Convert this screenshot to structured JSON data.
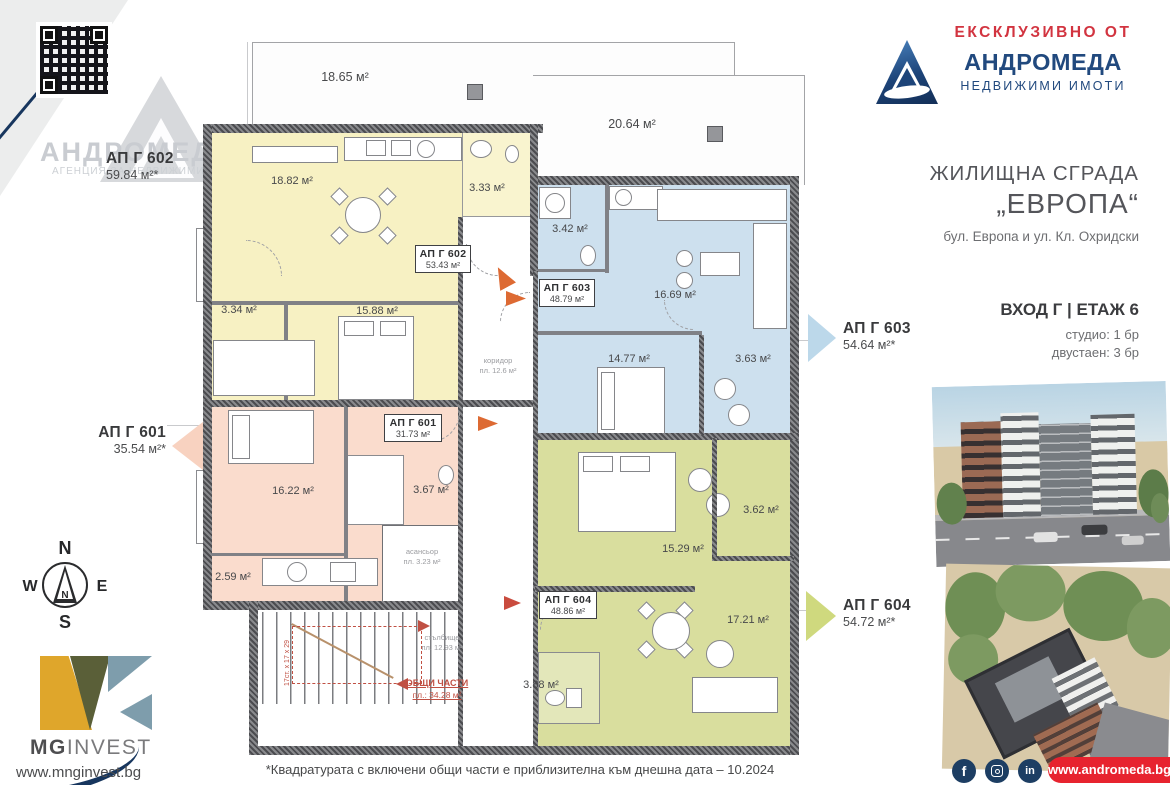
{
  "header": {
    "exclusive": "ЕКСКЛУЗИВНО ОТ",
    "agency": "АНДРОМЕДА",
    "tagline": "НЕДВИЖИМИ ИМОТИ"
  },
  "watermark": {
    "agency": "АНДРОМЕДА",
    "tagline": "АГЕНЦИЯ ЗА НЕДВИЖИМИ ИМОТИ"
  },
  "project": {
    "title1": "ЖИЛИЩНА СГРАДА",
    "title2": "„ЕВРОПА“",
    "address": "бул. Европа и ул. Кл. Охридски",
    "entrance": "ВХОД Г | ЕТАЖ 6",
    "mix1": "студио: 1 бр",
    "mix2": "двустаен: 3 бр"
  },
  "callouts": {
    "g602": {
      "name": "АП Г 602",
      "area": "59.84 м²*"
    },
    "g601": {
      "name": "АП Г 601",
      "area": "35.54 м²*"
    },
    "g603": {
      "name": "АП Г 603",
      "area": "54.64 м²*"
    },
    "g604": {
      "name": "АП Г 604",
      "area": "54.72 м²*"
    }
  },
  "plan": {
    "terrace_left": "18.65 м²",
    "terrace_right": "20.64 м²",
    "g602": {
      "name": "АП Г 602",
      "area": "53.43 м²",
      "living": "18.82 м²",
      "bath": "3.33 м²",
      "bedroom": "15.88 м²",
      "wardrobe": "3.34 м²"
    },
    "g603": {
      "name": "АП Г 603",
      "area": "48.79 м²",
      "bath": "3.42 м²",
      "living": "16.69 м²",
      "bedroom": "14.77 м²",
      "balcony": "3.63 м²"
    },
    "g601": {
      "name": "АП Г 601",
      "area": "31.73 м²",
      "living": "16.22 м²",
      "bath": "3.67 м²",
      "storage": "2.59 м²"
    },
    "g604": {
      "name": "АП Г 604",
      "area": "48.86 м²",
      "bedroom": "15.29 м²",
      "balcony": "3.62 м²",
      "living": "17.21 м²",
      "bath": "3.88 м²"
    },
    "corridor1": "коридор",
    "corridor2": "пл. 12.6 м²",
    "elevator1": "асансьор",
    "elevator2": "пл. 3.23 м²",
    "stairs1": "стълбище",
    "stairs2": "пл. 12.93 м²",
    "common1": "ОБЩИ ЧАСТИ",
    "common2": "пл.: 34.28 м²",
    "stair_dim": "17ст. х 17 х 29"
  },
  "compass": {
    "n": "N",
    "e": "E",
    "s": "S",
    "w": "W",
    "inner": "N"
  },
  "developer": {
    "bold": "MG",
    "light": "INVEST",
    "site": "www.mnginvest.bg"
  },
  "footer": {
    "disclaimer": "*Квадратурата с включени общи части е приблизителна към днешна дата – 10.2024",
    "site": "www.andromeda.bg",
    "fb": "f",
    "li": "in"
  }
}
